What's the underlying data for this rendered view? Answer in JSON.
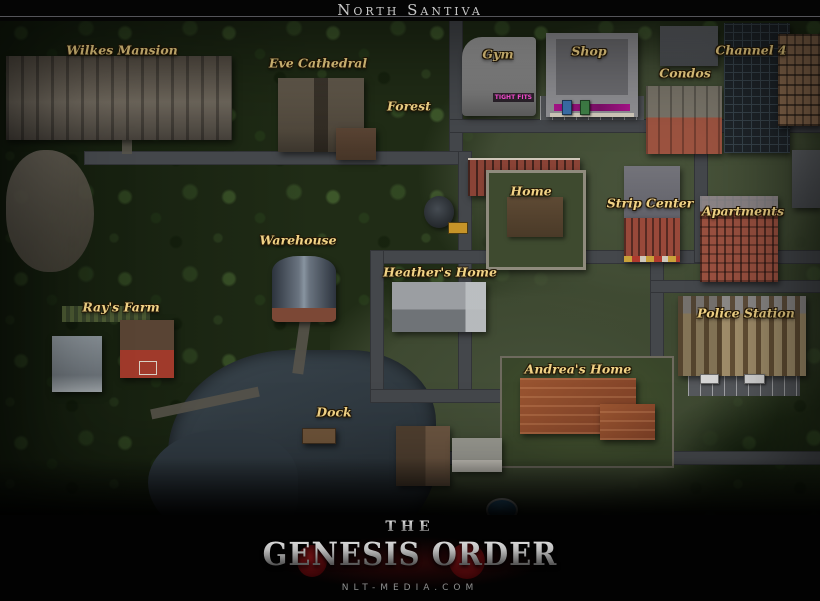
{
  "title_bar": {
    "title": "North Santiva"
  },
  "map": {
    "labels": [
      {
        "id": "wilkes-mansion",
        "text": "Wilkes Mansion",
        "x": 122,
        "y": 50
      },
      {
        "id": "eve-cathedral",
        "text": "Eve Cathedral",
        "x": 318,
        "y": 63
      },
      {
        "id": "forest",
        "text": "Forest",
        "x": 409,
        "y": 106
      },
      {
        "id": "gym",
        "text": "Gym",
        "x": 498,
        "y": 54
      },
      {
        "id": "shop",
        "text": "Shop",
        "x": 589,
        "y": 51
      },
      {
        "id": "channel-4",
        "text": "Channel 4",
        "x": 751,
        "y": 50
      },
      {
        "id": "condos",
        "text": "Condos",
        "x": 685,
        "y": 73
      },
      {
        "id": "home",
        "text": "Home",
        "x": 531,
        "y": 191
      },
      {
        "id": "strip-center",
        "text": "Strip Center",
        "x": 650,
        "y": 203
      },
      {
        "id": "apartments",
        "text": "Apartments",
        "x": 743,
        "y": 211
      },
      {
        "id": "warehouse",
        "text": "Warehouse",
        "x": 298,
        "y": 240
      },
      {
        "id": "heathers-home",
        "text": "Heather's Home",
        "x": 440,
        "y": 272
      },
      {
        "id": "rays-farm",
        "text": "Ray's Farm",
        "x": 121,
        "y": 307
      },
      {
        "id": "police-station",
        "text": "Police Station",
        "x": 746,
        "y": 313
      },
      {
        "id": "andreas-home",
        "text": "Andrea's Home",
        "x": 578,
        "y": 369
      },
      {
        "id": "dock",
        "text": "Dock",
        "x": 334,
        "y": 412
      }
    ],
    "signs": {
      "gym_sign": "TIGHT FITS"
    },
    "colors": {
      "label_gold": "#f1d386",
      "sign_pink": "#ff4fd8",
      "water": "#343f47",
      "road": "#44474b",
      "forest": "#202c16"
    }
  },
  "footer": {
    "logo_top": "The",
    "logo_main": "Genesis Order",
    "website": "nlt-media.com",
    "logo_silver": "#cfcfcf",
    "logo_red": "#5d0f12"
  }
}
